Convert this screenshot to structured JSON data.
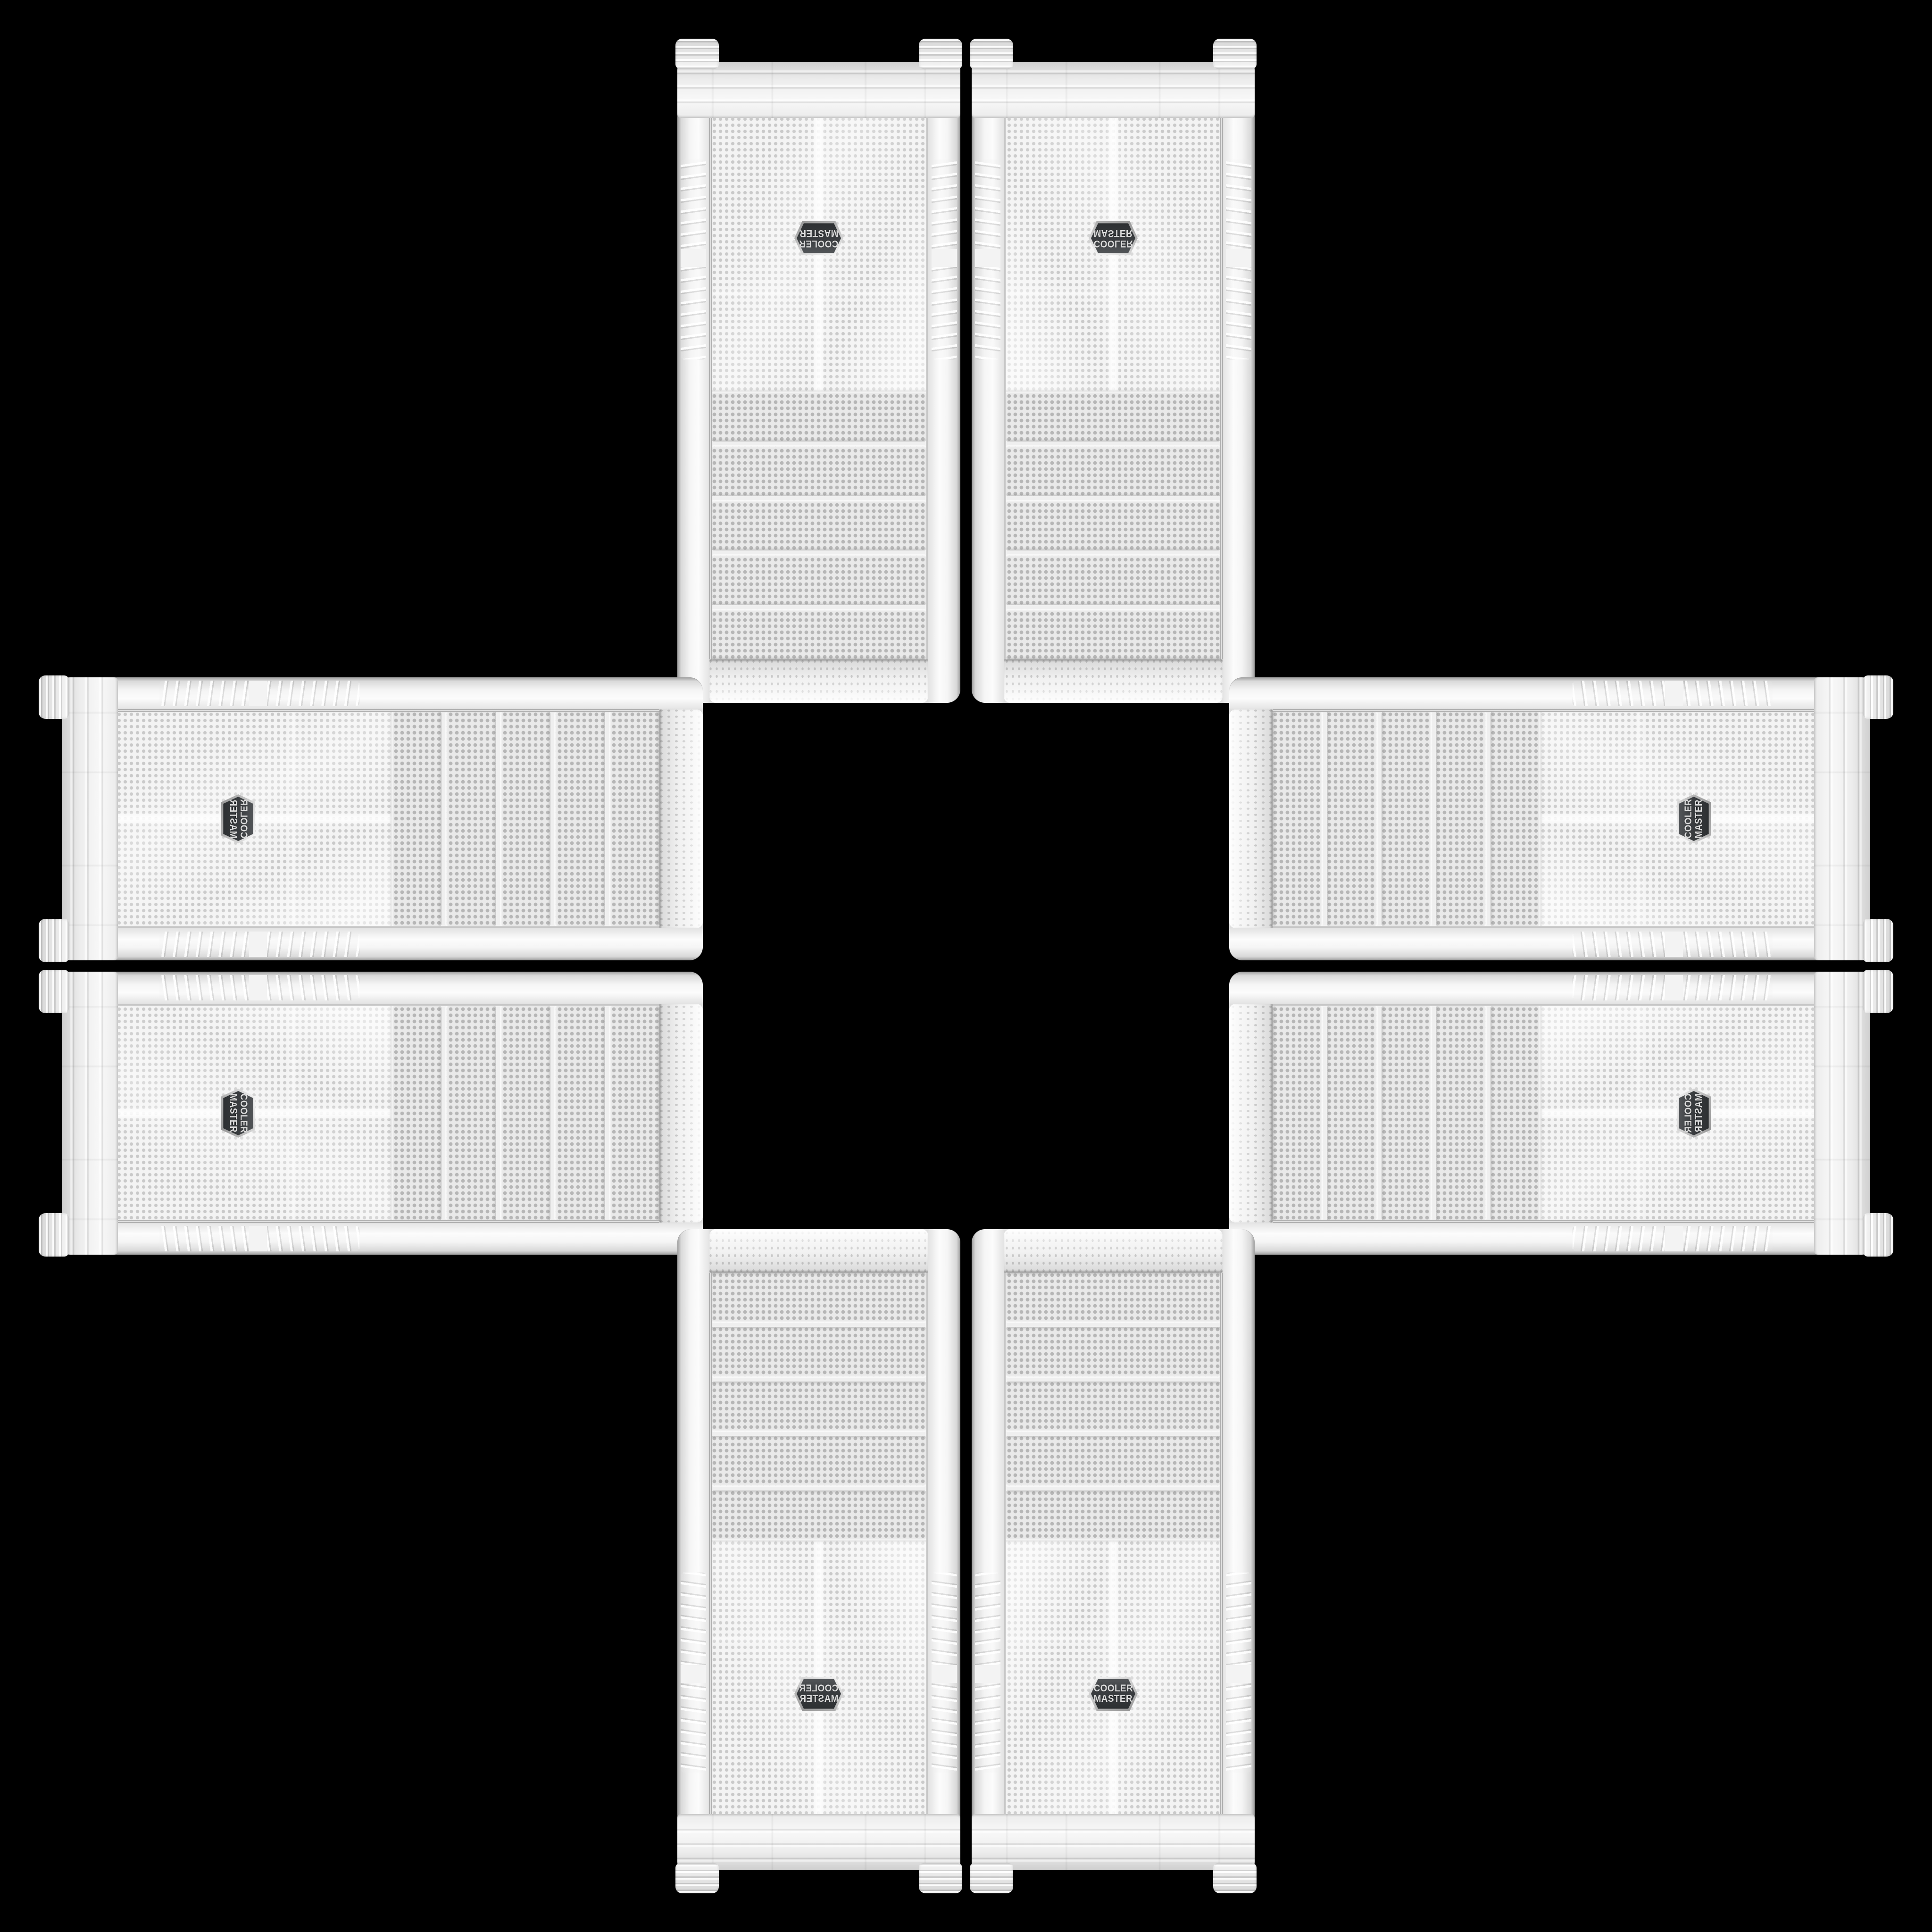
{
  "scene": {
    "name": "cooler-master-case-cross-arrangement",
    "background_color": "#000000"
  },
  "badge": {
    "line1": "COOLER",
    "line2": "MASTER"
  },
  "case_details": {
    "drive_bay_count": 5,
    "color_body": "#f2f2f2",
    "color_mesh_dot": "#c9c9c9",
    "color_bay_dot": "#b6b6b6",
    "color_badge_background": "#3a3d40",
    "color_badge_background_light": "#56595c",
    "color_badge_text": "#dcdcdc"
  },
  "cases": [
    {
      "position": "top-left",
      "orientation": "rotated-180"
    },
    {
      "position": "top-right",
      "orientation": "flipped-vertical"
    },
    {
      "position": "left-upper",
      "orientation": "rotated-90-flipped"
    },
    {
      "position": "left-lower",
      "orientation": "rotated-90"
    },
    {
      "position": "right-upper",
      "orientation": "rotated-270"
    },
    {
      "position": "right-lower",
      "orientation": "rotated-90-transposed"
    },
    {
      "position": "bottom-left",
      "orientation": "flipped-horizontal"
    },
    {
      "position": "bottom-right",
      "orientation": "upright"
    }
  ]
}
